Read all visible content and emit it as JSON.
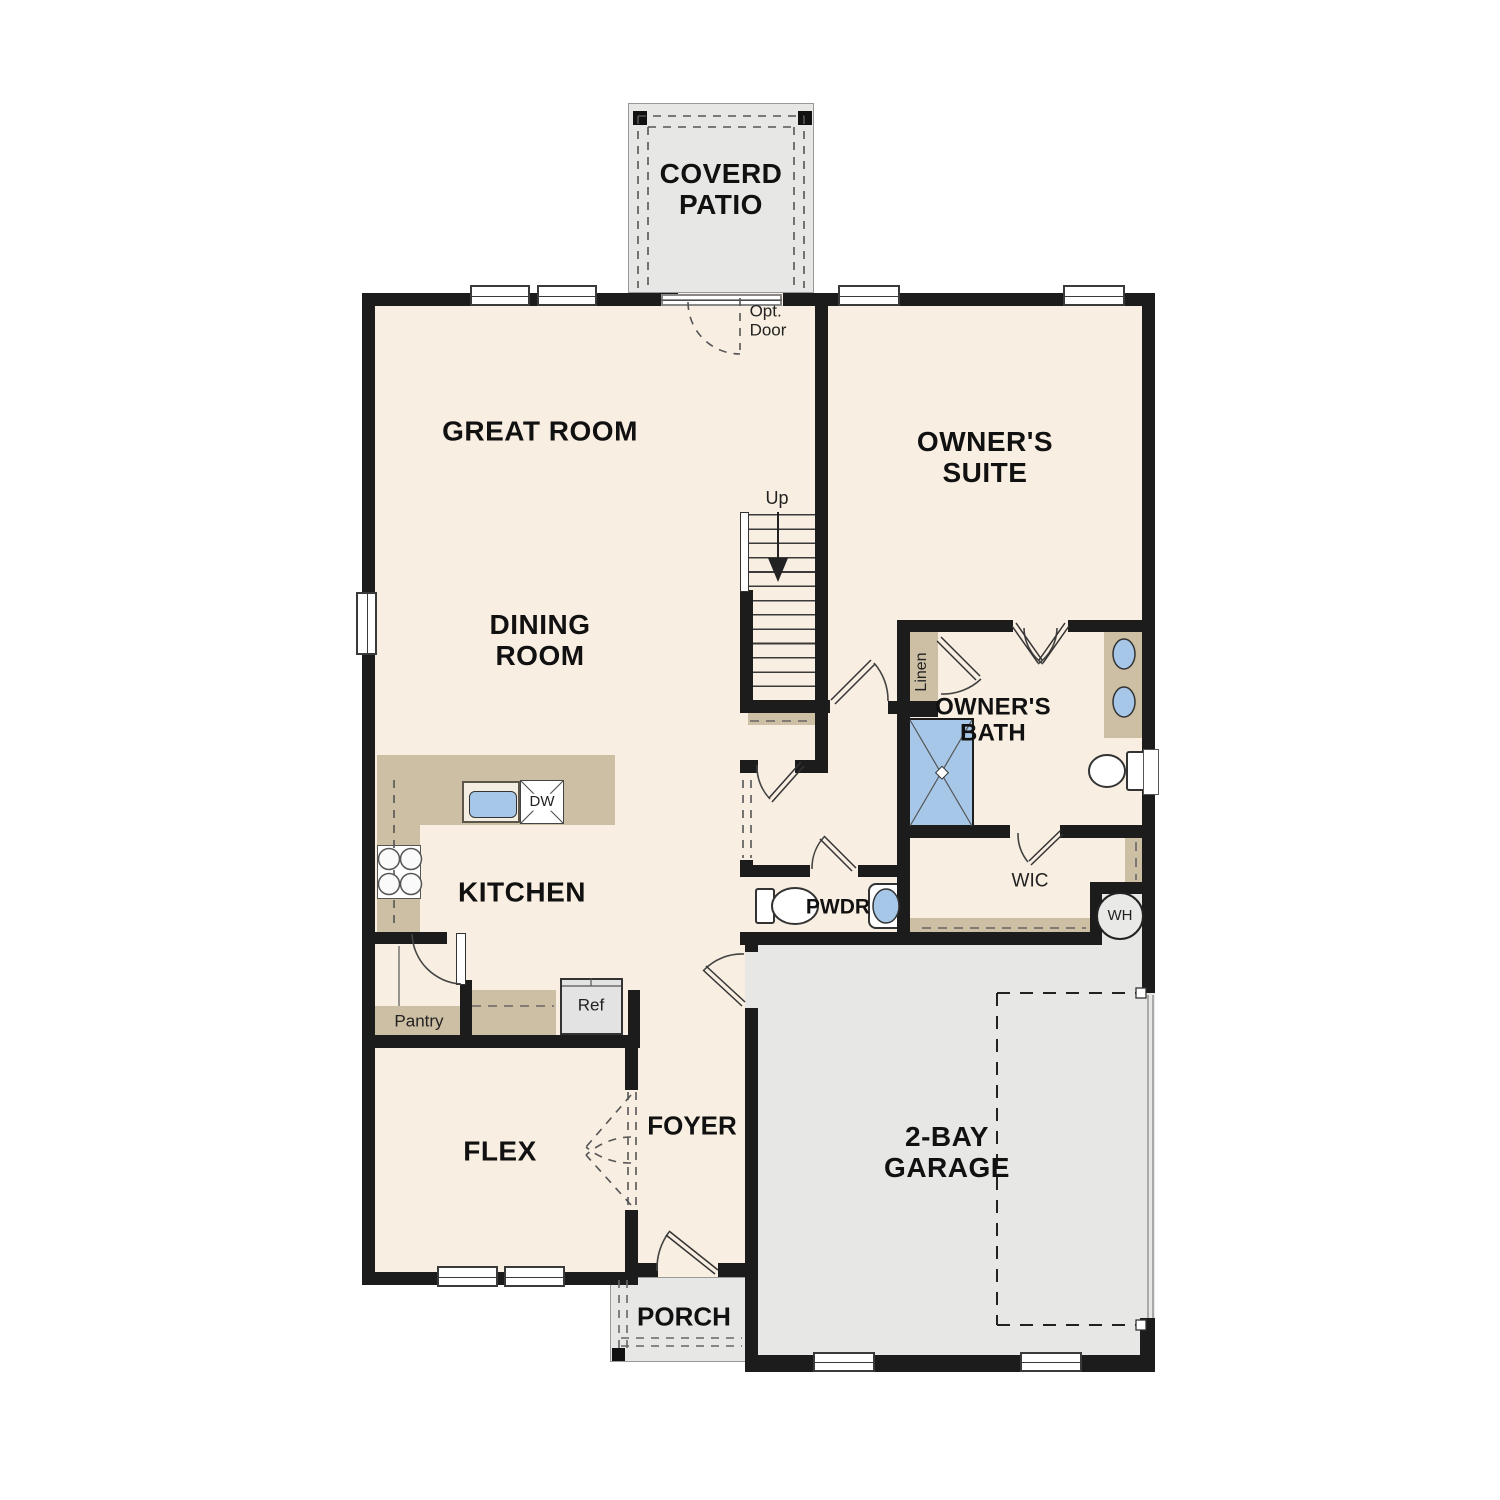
{
  "floorplan": {
    "rooms": {
      "coverd_patio": "COVERD\nPATIO",
      "great_room": "GREAT ROOM",
      "owners_suite": "OWNER'S\nSUITE",
      "dining_room": "DINING\nROOM",
      "owners_bath": "OWNER'S\nBATH",
      "kitchen": "KITCHEN",
      "wic": "WIC",
      "pwdr": "PWDR",
      "flex": "FLEX",
      "foyer": "FOYER",
      "garage": "2-BAY\nGARAGE",
      "porch": "PORCH"
    },
    "annotations": {
      "opt_door": "Opt.\nDoor",
      "up": "Up",
      "linen": "Linen",
      "pantry": "Pantry",
      "ref": "Ref",
      "dw": "DW",
      "wh": "WH"
    },
    "colors": {
      "wall": "#1c1c1c",
      "room_fill": "#f8eee1",
      "cabinet_tan": "#cdbfa3",
      "exterior_gray": "#e7e7e5",
      "fixture_blue": "#a7c7e8"
    }
  }
}
